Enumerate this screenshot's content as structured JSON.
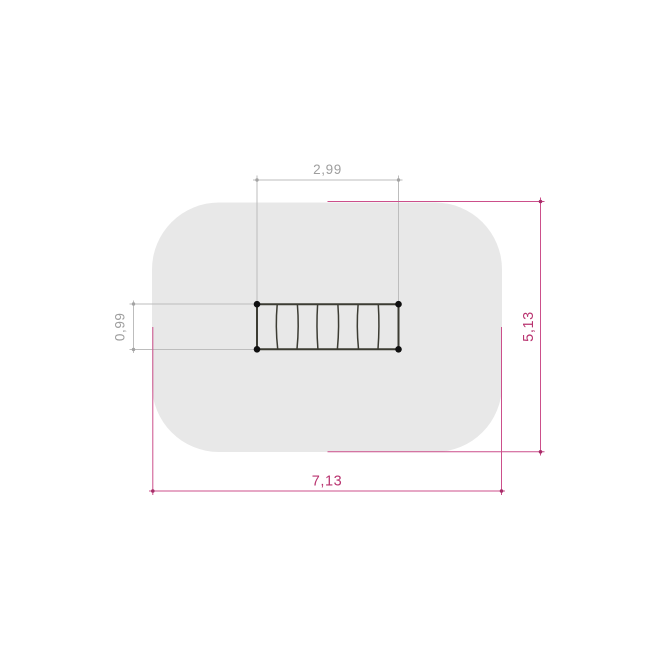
{
  "canvas": {
    "width": 660,
    "height": 660,
    "background": "#ffffff"
  },
  "drawing": {
    "safety_zone": {
      "shape": "rounded-rectangle",
      "fill": "#e8e8e8",
      "width_label": "7,13",
      "depth_label": "5,13"
    },
    "equipment": {
      "shape": "ladder-top-view",
      "rung_count": 6,
      "width_label": "2,99",
      "depth_label": "0,99"
    },
    "colors": {
      "zone_dim_line": "#cc4f8b",
      "zone_dim_text": "#b93470",
      "equipment_dim_line": "#bdbdbd",
      "equipment_dim_text": "#9e9e9e",
      "equipment_stroke": "#3c3c33",
      "corner_dot": "#101010"
    }
  }
}
